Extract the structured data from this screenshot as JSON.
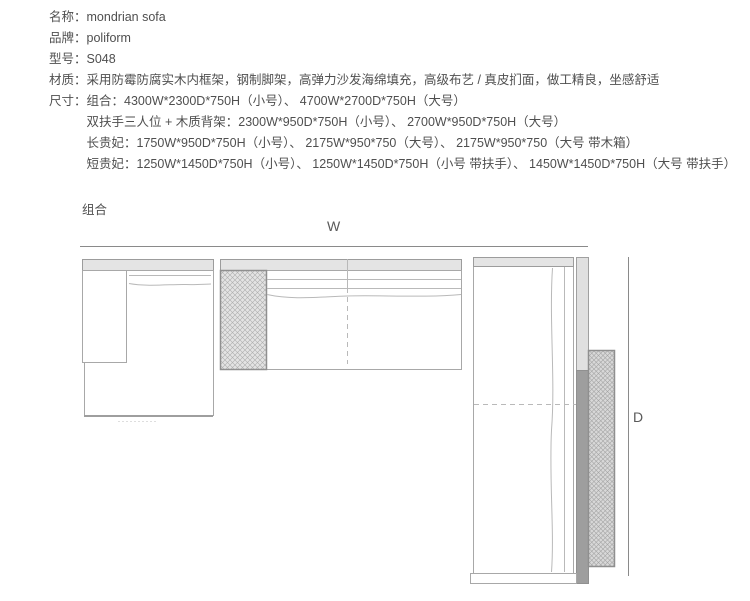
{
  "specs": [
    {
      "label": "名称：",
      "value": "mondrian sofa"
    },
    {
      "label": "品牌：",
      "value": "poliform"
    },
    {
      "label": "型号：",
      "value": "S048"
    },
    {
      "label": "材质：",
      "value": "采用防霉防腐实木内框架，钢制脚架，高弹力沙发海绵填充，高级布艺 / 真皮扪面，做工精良，坐感舒适"
    },
    {
      "label": "尺寸：",
      "value_lines": [
        "组合：4300W*2300D*750H（小号）、 4700W*2700D*750H（大号）",
        "双扶手三人位 + 木质背架：2300W*950D*750H（小号）、 2700W*950D*750H（大号）",
        "长贵妃：1750W*950D*750H（小号）、 2175W*950*750（大号）、 2175W*950*750（大号 带木箱）",
        "短贵妃：1250W*1450D*750H（小号）、 1250W*1450D*750H（小号 带扶手）、 1450W*1450D*750H（大号 带扶手）"
      ]
    }
  ],
  "diagram": {
    "section_label": "组合",
    "dim_w": "W",
    "dim_d": "D"
  },
  "theme": {
    "text": "#4f4f4f",
    "line": "#a8a8a8",
    "thin": "#b9b9b9",
    "dim": "#8a8a8a",
    "band": "#e4e4e4",
    "strip-light": "#e0e0e0",
    "strip-dark": "#9e9e9e",
    "hatch-bg": "#e3e3e3",
    "hatch-line": "#adadad",
    "hatch2-bg": "#d8d8d8",
    "hatch2-line": "#a2a2a2"
  }
}
